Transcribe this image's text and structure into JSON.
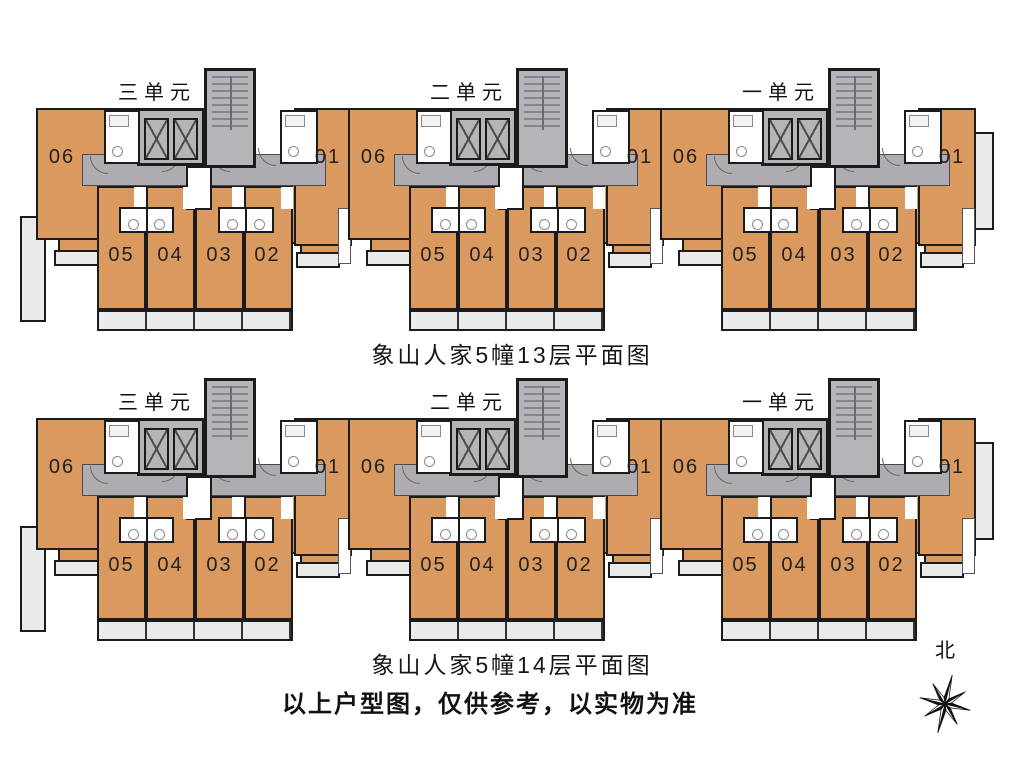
{
  "sheet": {
    "floors": [
      {
        "caption": "象山人家5幢13层平面图",
        "units": [
          {
            "label": "三单元"
          },
          {
            "label": "二单元"
          },
          {
            "label": "一单元"
          }
        ]
      },
      {
        "caption": "象山人家5幢14层平面图",
        "units": [
          {
            "label": "三单元"
          },
          {
            "label": "二单元"
          },
          {
            "label": "一单元"
          }
        ]
      }
    ],
    "apartments": {
      "a01": "01",
      "a02": "02",
      "a03": "03",
      "a04": "04",
      "a05": "05",
      "a06": "06"
    },
    "disclaimer": "以上户型图，仅供参考，以实物为准",
    "compass_label": "北",
    "colors": {
      "room": "#d9995f",
      "corridor": "#aeacb0",
      "stair": "#b6b4b8",
      "balcony": "#e8eaec",
      "wall": "#1b1b1b"
    }
  }
}
